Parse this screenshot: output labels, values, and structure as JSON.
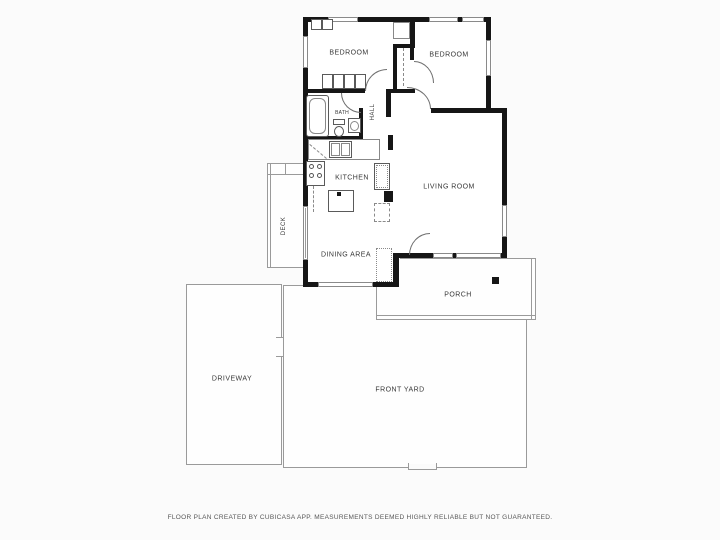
{
  "plan": {
    "rooms": [
      {
        "id": "bedroom-1",
        "label": "BEDROOM"
      },
      {
        "id": "bedroom-2",
        "label": "BEDROOM"
      },
      {
        "id": "bath",
        "label": "BATH"
      },
      {
        "id": "hall",
        "label": "HALL"
      },
      {
        "id": "kitchen",
        "label": "KITCHEN"
      },
      {
        "id": "living-room",
        "label": "LIVING ROOM"
      },
      {
        "id": "dining-area",
        "label": "DINING AREA"
      },
      {
        "id": "deck",
        "label": "DECK"
      },
      {
        "id": "porch",
        "label": "PORCH"
      },
      {
        "id": "driveway",
        "label": "DRIVEWAY"
      },
      {
        "id": "front-yard",
        "label": "FRONT YARD"
      }
    ],
    "footer": "FLOOR PLAN CREATED BY CUBICASA APP. MEASUREMENTS DEEMED HIGHLY RELIABLE BUT NOT GUARANTEED.",
    "colors": {
      "wall": "#161616",
      "thin_line": "#9a9a9a",
      "label": "#383838",
      "footer_text": "#575757",
      "background": "#fbfbfb"
    }
  }
}
